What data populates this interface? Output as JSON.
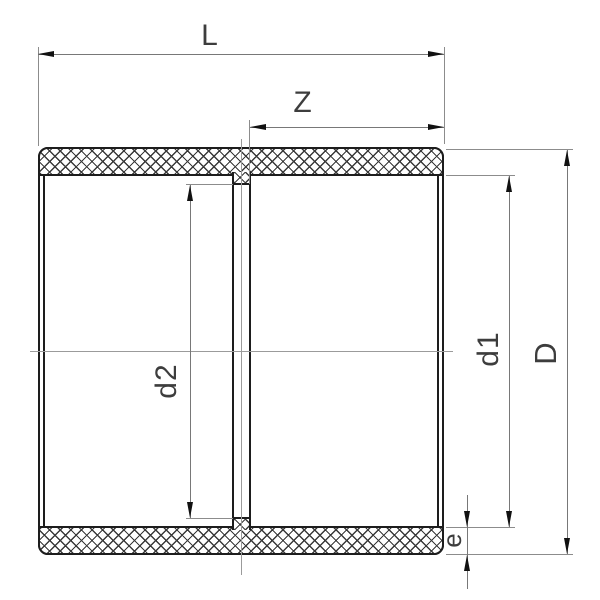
{
  "drawing": {
    "labels": {
      "overall_length": "L",
      "socket_depth": "Z",
      "stop_bore": "d2",
      "socket_bore": "d1",
      "outer_diameter": "D",
      "wall_thickness": "e"
    },
    "colors": {
      "background": "#ffffff",
      "body_line": "#1d1d1d",
      "dimension_line": "#787878",
      "extension_line": "#8c8c8c",
      "centerline": "#9b9b9b",
      "arrow": "#111111",
      "hatch_line": "#3a3a3a",
      "label_text": "#3d3d3d"
    }
  }
}
